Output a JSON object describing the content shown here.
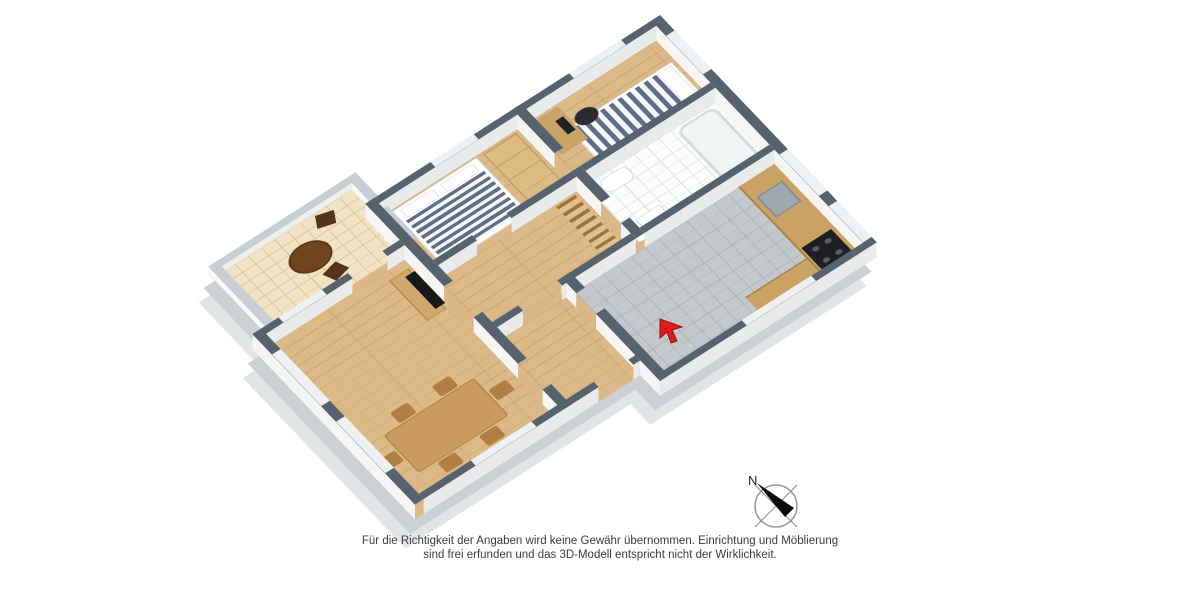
{
  "page": {
    "background_color": "#ffffff"
  },
  "floorplan": {
    "type": "3d-floor-plan-render",
    "rooms": [
      {
        "name": "bedroom-small",
        "floor": "wood",
        "furniture": [
          "single-bed-striped",
          "desk",
          "office-chair"
        ]
      },
      {
        "name": "bathroom",
        "floor": "white-tile",
        "furniture": [
          "bathtub",
          "toilet",
          "sink"
        ]
      },
      {
        "name": "kitchen",
        "floor": "gray-tile",
        "furniture": [
          "counter",
          "sink",
          "stove"
        ]
      },
      {
        "name": "hallway",
        "floor": "wood",
        "furniture": [
          "shelf"
        ]
      },
      {
        "name": "bedroom-master",
        "floor": "wood",
        "furniture": [
          "double-bed-striped",
          "wardrobe"
        ]
      },
      {
        "name": "living-dining-room",
        "floor": "wood",
        "furniture": [
          "tv-board",
          "tv",
          "dining-table",
          "chairs"
        ]
      },
      {
        "name": "balcony",
        "floor": "cream-tile",
        "furniture": [
          "round-table",
          "chairs"
        ]
      }
    ],
    "entrance_marker": "red-arrow",
    "colors": {
      "wall_top": "#57626f",
      "wall_side": "#f5f5f3",
      "wood_floor": "#ddb988",
      "balcony_tile": "#f1e3c3",
      "bath_tile": "#fbfcfc",
      "kitchen_tile": "#c3c8cc",
      "mattress_stripe": "#5f6d86",
      "accent_red": "#e01b1b",
      "base_slab": "#cbd0d3"
    }
  },
  "compass": {
    "label": "N"
  },
  "disclaimer": {
    "line1": "Für die Richtigkeit der Angaben wird keine Gewähr übernommen. Einrichtung und Möblierung",
    "line2": "sind frei erfunden und das 3D-Modell entspricht nicht der Wirklichkeit."
  }
}
